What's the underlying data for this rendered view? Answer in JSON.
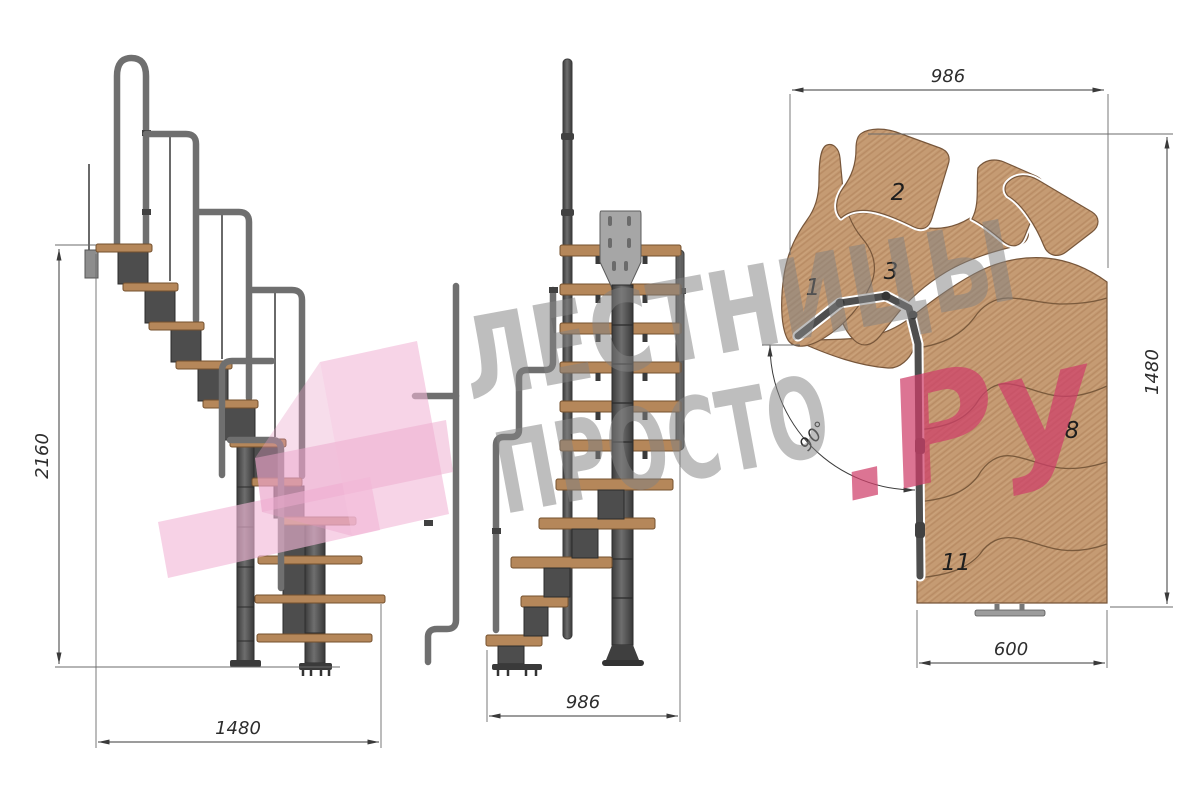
{
  "drawing": {
    "side_view": {
      "height_label": "2160",
      "length_label": "1480"
    },
    "front_view": {
      "width_label": "986"
    },
    "plan_view": {
      "top_label": "986",
      "right_label": "1480",
      "bottom_label": "600",
      "angle_label": "90°",
      "tread_labels": [
        "1",
        "2",
        "3",
        "8",
        "11"
      ]
    }
  },
  "watermark": {
    "line1": "ЛЕСТНИЦЫ",
    "line2": "ПРОСТО",
    "suffix": ".Ру"
  },
  "colors": {
    "wood": "#c59b73",
    "wood_edge": "#77563a",
    "tread_elevation": "#b5875a",
    "metal_module": "#4d4d4d",
    "handrail": "#6f6f6f",
    "mount_plate": "#a6a6a6",
    "dimension": "#3a3a3a",
    "watermark_gray": "#828282",
    "watermark_pink": "#cf3f69",
    "ribbon_pink": "#f2b7d7"
  }
}
